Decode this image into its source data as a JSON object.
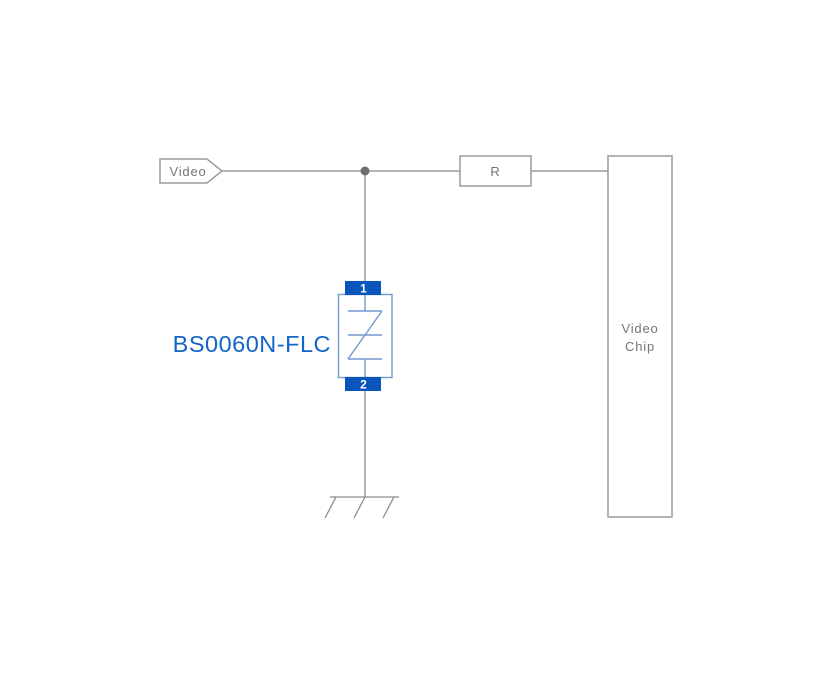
{
  "diagram": {
    "video_net": {
      "label": "Video"
    },
    "resistor": {
      "label": "R"
    },
    "video_chip": {
      "line1": "Video",
      "line2": "Chip"
    },
    "tvs": {
      "part_number": "BS0060N-FLC",
      "pin1_label": "1",
      "pin2_label": "2"
    },
    "colors": {
      "wire_gray": "#9b9b9b",
      "label_gray": "#757575",
      "tvs_pad_blue": "#0a56bd",
      "tvs_symbol_blue": "#7399d2",
      "part_number_blue": "#1565c8"
    }
  }
}
